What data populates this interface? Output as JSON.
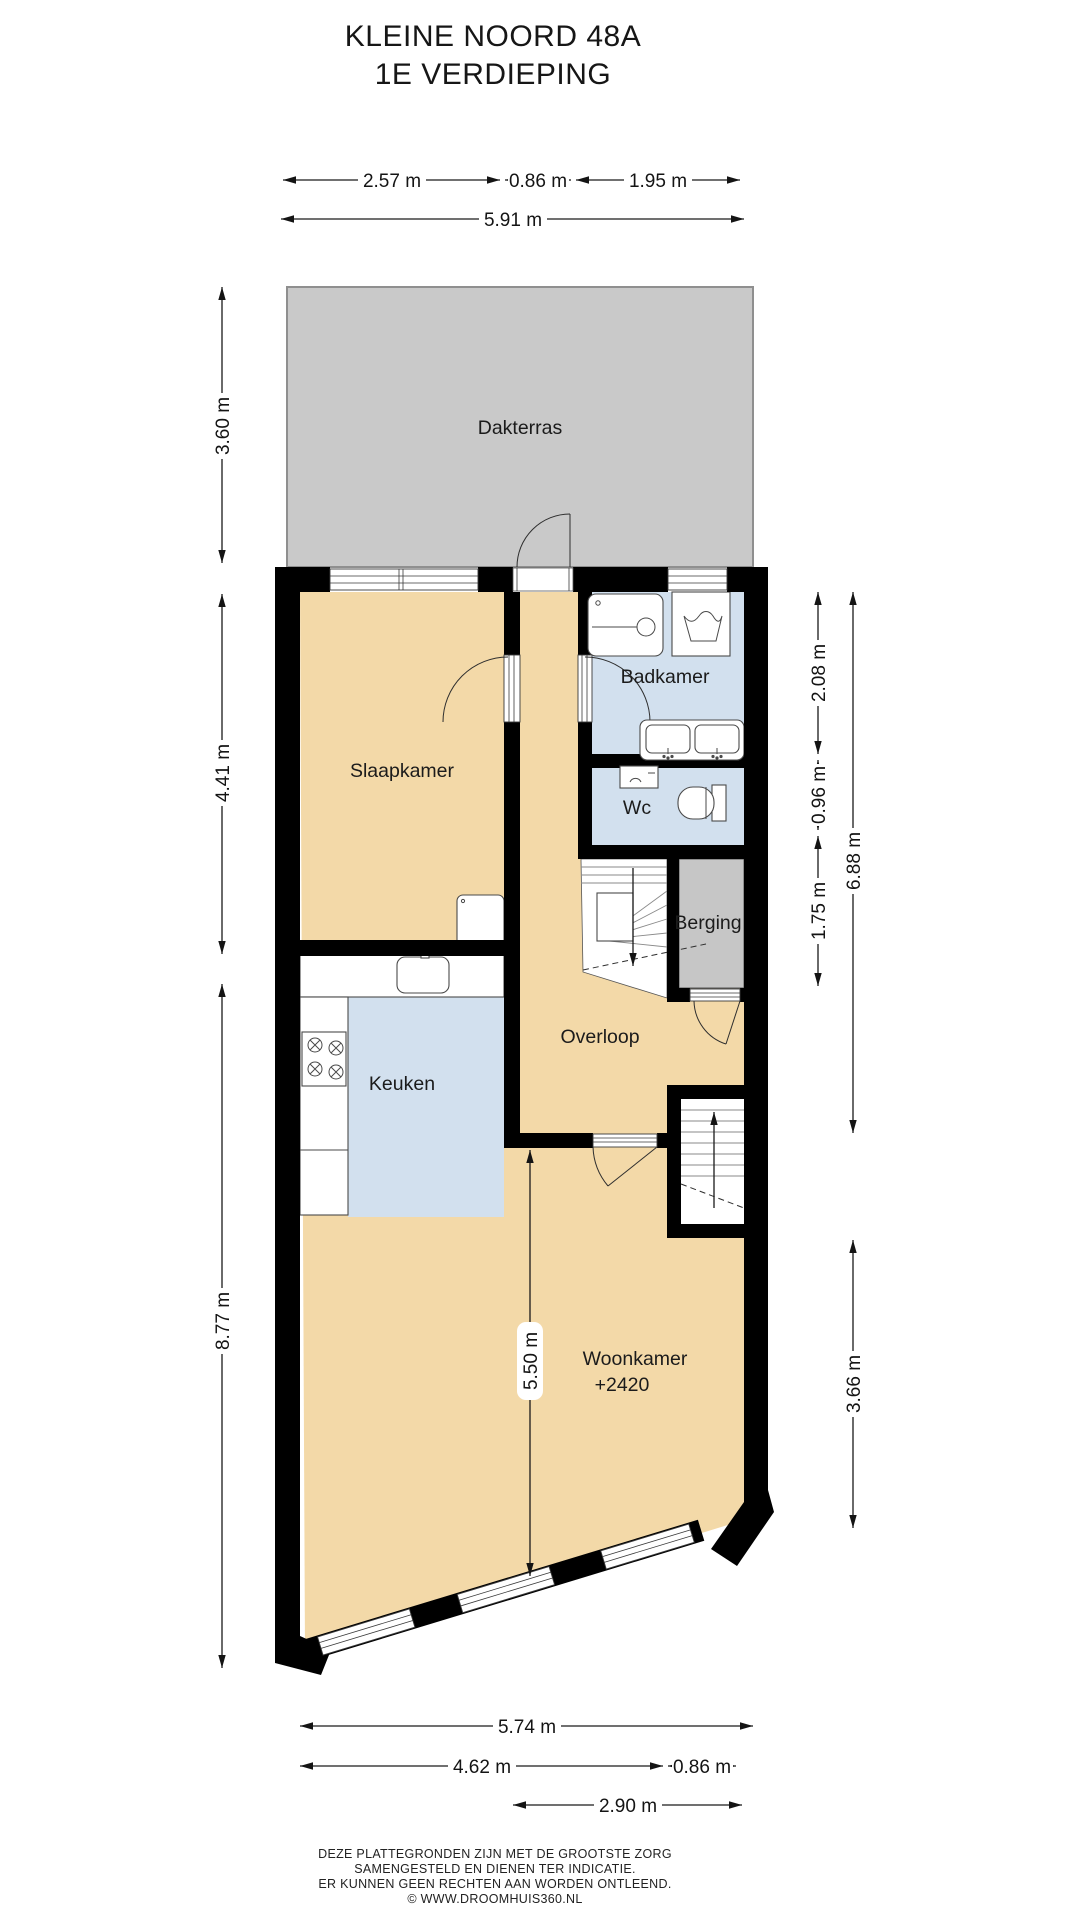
{
  "title": {
    "line1": "KLEINE NOORD 48A",
    "line2": "1E VERDIEPING"
  },
  "rooms": {
    "dakterras": "Dakterras",
    "slaapkamer": "Slaapkamer",
    "badkamer": "Badkamer",
    "wc": "Wc",
    "berging": "Berging",
    "overloop": "Overloop",
    "keuken": "Keuken",
    "woonkamer": "Woonkamer",
    "woonkamer_level": "+2420"
  },
  "dimensions": {
    "top_segments": [
      "2.57 m",
      "0.86 m",
      "1.95 m"
    ],
    "top_total": "5.91 m",
    "left": [
      "3.60 m",
      "4.41 m",
      "8.77 m"
    ],
    "right_segments": [
      "2.08 m",
      "0.96 m",
      "1.75 m"
    ],
    "right_total": "6.88 m",
    "right_lower": "3.66 m",
    "interior_vertical": "5.50 m",
    "bottom_total": "5.74 m",
    "bottom_segments": [
      "4.62 m",
      "0.86 m"
    ],
    "bottom_inner": "2.90 m"
  },
  "footer": {
    "line1": "DEZE PLATTEGRONDEN ZIJN MET DE GROOTSTE ZORG",
    "line2": "SAMENGESTELD EN DIENEN TER INDICATIE.",
    "line3": "ER KUNNEN GEEN RECHTEN AAN WORDEN ONTLEEND.",
    "line4": "© WWW.DROOMHUIS360.NL"
  },
  "colors": {
    "wall": "#000000",
    "floor_living": "#f3d9a8",
    "floor_wet": "#d2e0ee",
    "terrace": "#c9c9c9",
    "storage": "#c6c6c6",
    "dimension_text": "#141414"
  }
}
